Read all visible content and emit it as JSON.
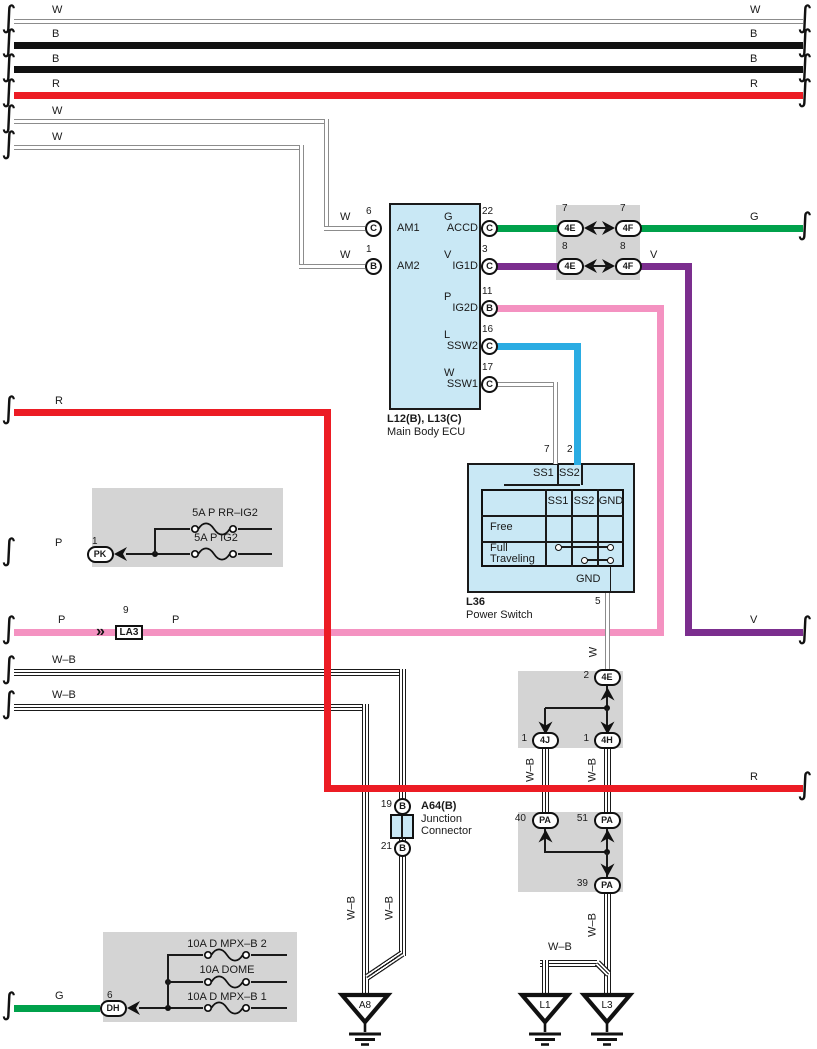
{
  "colors": {
    "red": "#EC1C24",
    "pink": "#F492C1",
    "green": "#00A14B",
    "purple": "#7B2E8E",
    "blue": "#2AACE3",
    "boxblue": "#C9E8F5",
    "boxgray": "#D4D4D4"
  },
  "icons": {
    "wire_break": "∫",
    "double_chevron": "»"
  },
  "labels": {
    "W": "W",
    "B": "B",
    "R": "R",
    "G": "G",
    "V": "V",
    "P": "P",
    "L": "L",
    "WB": "W–B"
  },
  "ecu": {
    "id": "L12(B), L13(C)",
    "name": "Main Body ECU",
    "pins": {
      "am1": {
        "num": "6",
        "term": "C",
        "label": "AM1"
      },
      "am2": {
        "num": "1",
        "term": "B",
        "label": "AM2"
      },
      "accd": {
        "num": "22",
        "term": "C",
        "label": "ACCD"
      },
      "ig1d": {
        "num": "3",
        "term": "C",
        "label": "IG1D"
      },
      "ig2d": {
        "num": "11",
        "term": "B",
        "label": "IG2D"
      },
      "ssw2": {
        "num": "16",
        "term": "C",
        "label": "SSW2"
      },
      "ssw1": {
        "num": "17",
        "term": "C",
        "label": "SSW1"
      }
    }
  },
  "connector_pairs": {
    "row1": {
      "left": {
        "num": "7",
        "id": "4E"
      },
      "right": {
        "num": "7",
        "id": "4F"
      }
    },
    "row2": {
      "left": {
        "num": "8",
        "id": "4E"
      },
      "right": {
        "num": "8",
        "id": "4F"
      }
    }
  },
  "power_switch": {
    "id": "L36",
    "name": "Power Switch",
    "pin_ss1": {
      "num": "7",
      "label": "SS1"
    },
    "pin_ss2": {
      "num": "2",
      "label": "SS2"
    },
    "table": {
      "col1": "SS1",
      "col2": "SS2",
      "col3": "GND",
      "row1": "Free",
      "row2a": "Full",
      "row2b": "Traveling"
    },
    "gnd": {
      "label": "GND",
      "num": "5"
    }
  },
  "la3": {
    "num": "9",
    "id": "LA3"
  },
  "pk": {
    "num": "1",
    "id": "PK"
  },
  "dh": {
    "num": "6",
    "id": "DH"
  },
  "fuses_upper": {
    "f1": "5A P RR–IG2",
    "f2": "5A P IG2"
  },
  "fuses_lower": {
    "f1": "10A D MPX–B 2",
    "f2": "10A DOME",
    "f3": "10A D MPX–B 1"
  },
  "mid_connectors": {
    "e2": {
      "num": "2",
      "id": "4E"
    },
    "j1": {
      "num": "1",
      "id": "4J"
    },
    "h1": {
      "num": "1",
      "id": "4H"
    },
    "pa40": {
      "num": "40",
      "id": "PA"
    },
    "pa51": {
      "num": "51",
      "id": "PA"
    },
    "pa39": {
      "num": "39",
      "id": "PA"
    }
  },
  "junction_connector": {
    "id": "A64(B)",
    "name1": "Junction",
    "name2": "Connector",
    "pin_top": {
      "num": "19",
      "term": "B"
    },
    "pin_bottom": {
      "num": "21",
      "term": "B"
    }
  },
  "grounds": {
    "g1": "A8",
    "g2": "L1",
    "g3": "L3"
  }
}
